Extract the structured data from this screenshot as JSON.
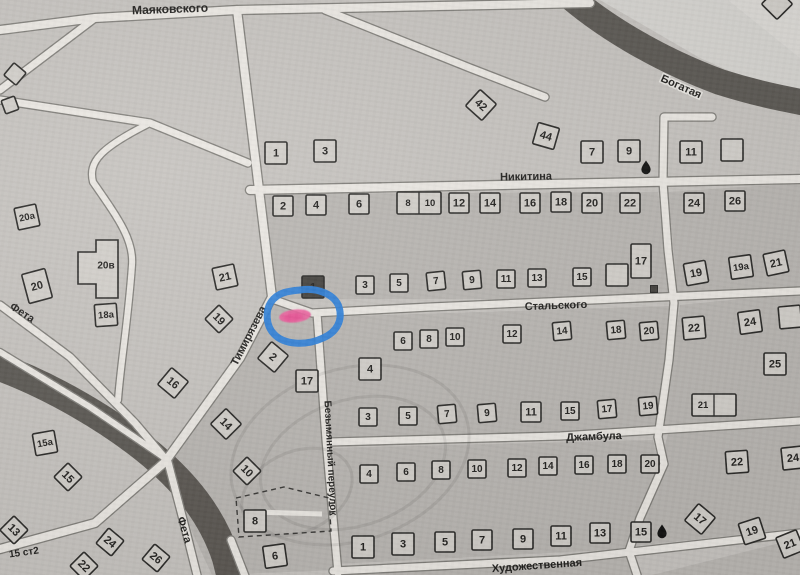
{
  "map_title": "Scanned cadastral street map with highlighted plot",
  "colors": {
    "paper": "#c6c3bf",
    "block": "#b9b6b2",
    "road": "#ebe8e3",
    "road_edge": "#82807b",
    "river": "#55524d",
    "building_fill": "#d2cfca",
    "building_dark": "#45433f",
    "ink": "#2b2a28",
    "annotation_blue": "#2c7fd9",
    "annotation_pink": "#ee5f9e"
  },
  "shading": [
    {
      "pts": "600,0 800,0 800,102 700,58",
      "fill": "#d6d4d0",
      "op": 1
    },
    {
      "pts": "728,0 800,0 800,58",
      "fill": "#dedcd8",
      "op": 0.75
    }
  ],
  "blocks": [
    "256,194 658,192 670,299 274,299",
    "668,192 800,183 800,288 678,297",
    "322,317 672,306 666,433 331,437",
    "272,302 316,316 337,570 212,575 192,532 170,463 240,358",
    "680,305 800,293 800,417 663,429",
    "333,448 653,440 660,467 636,519 627,549 337,564",
    "669,431 800,424 800,528 635,546",
    "340,575 631,557 641,575",
    "652,575 800,538 800,575"
  ],
  "rivers": [
    {
      "d": "M560,-12 C600,25 660,60 720,82 C755,93 780,98 806,103",
      "w": 26
    },
    {
      "d": "M-6,365 C50,385 110,420 152,455 C185,483 212,515 226,558 L231,578",
      "w": 28
    }
  ],
  "roads": [
    {
      "d": "M0,30 L95,18 L237,10 L590,3",
      "w": 8
    },
    {
      "d": "M325,10 L470,68 L545,97",
      "w": 7
    },
    {
      "d": "M95,18 L0,90",
      "w": 7
    },
    {
      "d": "M0,100 L150,123 L248,163",
      "w": 7
    },
    {
      "d": "M150,123 C100,148 88,162 93,182 C118,218 134,240 132,265 C128,322 121,360 118,400",
      "w": 6
    },
    {
      "d": "M237,10 L256,165 L272,297 L240,358 L165,462 L95,523 L0,549",
      "w": 8
    },
    {
      "d": "M0,305 L70,357 L135,423 L168,462 L186,531 L197,575",
      "w": 7
    },
    {
      "d": "M0,352 L90,407 L162,456",
      "w": 6
    },
    {
      "d": "M231,540 L245,576",
      "w": 7
    },
    {
      "d": "M250,190 L800,179",
      "w": 8
    },
    {
      "d": "M272,299 L312,313 L430,307 L800,291",
      "w": 7
    },
    {
      "d": "M330,442 L560,436 L800,421",
      "w": 7
    },
    {
      "d": "M333,571 L560,560 L800,533",
      "w": 7
    },
    {
      "d": "M317,313 L326,440 L338,573",
      "w": 7
    },
    {
      "d": "M712,117 L664,117 L663,182 L668,250 L674,303 L669,360 L658,437 L664,464 L640,518 L629,551 L637,575",
      "w": 7
    }
  ],
  "stamp": [
    {
      "cx": 350,
      "cy": 455,
      "rx": 122,
      "ry": 86,
      "rot": -18
    },
    {
      "cx": 353,
      "cy": 463,
      "rx": 95,
      "ry": 63,
      "rot": -18
    },
    {
      "cx": 297,
      "cy": 492,
      "rx": 58,
      "ry": 40,
      "rot": -25
    }
  ],
  "dashed_parcel": {
    "pts": "236,498 284,487 329,498 331,531 239,537",
    "strip": {
      "x1": 252,
      "y1": 512,
      "x2": 322,
      "y2": 514
    }
  },
  "cross_building": {
    "points": "78,252 96,252 96,240 118,240 118,298 96,298 96,284 78,284",
    "label": "20в",
    "lx": 106,
    "ly": 266
  },
  "buildings": [
    {
      "n": "1",
      "x": 276,
      "y": 153
    },
    {
      "n": "3",
      "x": 325,
      "y": 151
    },
    {
      "n": "42",
      "x": 481,
      "y": 105,
      "r": 42
    },
    {
      "n": "44",
      "x": 546,
      "y": 136,
      "r": 16
    },
    {
      "n": "7",
      "x": 592,
      "y": 152
    },
    {
      "n": "9",
      "x": 629,
      "y": 151
    },
    {
      "n": "11",
      "x": 691,
      "y": 152
    },
    {
      "n": "",
      "x": 732,
      "y": 150
    },
    {
      "n": "",
      "x": 777,
      "y": 4,
      "r": 45
    },
    {
      "n": "2",
      "x": 283,
      "y": 206,
      "w": 20
    },
    {
      "n": "4",
      "x": 316,
      "y": 205,
      "w": 20
    },
    {
      "n": "6",
      "x": 359,
      "y": 204,
      "w": 20
    },
    {
      "n": "8|10",
      "x": 419,
      "y": 203
    },
    {
      "n": "12",
      "x": 459,
      "y": 203,
      "w": 20
    },
    {
      "n": "14",
      "x": 490,
      "y": 203,
      "w": 20
    },
    {
      "n": "16",
      "x": 530,
      "y": 203,
      "w": 20
    },
    {
      "n": "18",
      "x": 561,
      "y": 202,
      "w": 20
    },
    {
      "n": "20",
      "x": 592,
      "y": 203,
      "w": 20
    },
    {
      "n": "22",
      "x": 630,
      "y": 203,
      "w": 20
    },
    {
      "n": "24",
      "x": 694,
      "y": 203,
      "w": 20
    },
    {
      "n": "26",
      "x": 735,
      "y": 201,
      "w": 20
    },
    {
      "n": "1",
      "x": 313,
      "y": 287,
      "t": "d"
    },
    {
      "n": "3",
      "x": 365,
      "y": 285,
      "w": 18
    },
    {
      "n": "5",
      "x": 399,
      "y": 283,
      "w": 18
    },
    {
      "n": "7",
      "x": 436,
      "y": 281,
      "w": 18,
      "r": -6
    },
    {
      "n": "9",
      "x": 472,
      "y": 280,
      "w": 18,
      "r": -5
    },
    {
      "n": "11",
      "x": 506,
      "y": 279,
      "w": 18
    },
    {
      "n": "13",
      "x": 537,
      "y": 278,
      "w": 18
    },
    {
      "n": "15",
      "x": 582,
      "y": 277,
      "w": 18
    },
    {
      "n": "",
      "x": 617,
      "y": 275
    },
    {
      "n": "17",
      "x": 641,
      "y": 261,
      "w": 20,
      "h": 34
    },
    {
      "n": "19",
      "x": 696,
      "y": 273,
      "r": -10
    },
    {
      "n": "19а",
      "x": 741,
      "y": 267,
      "r": -8
    },
    {
      "n": "21",
      "x": 776,
      "y": 263,
      "r": -12
    },
    {
      "n": "2",
      "x": 273,
      "y": 357,
      "r": 40
    },
    {
      "n": "17",
      "x": 307,
      "y": 381
    },
    {
      "n": "10",
      "x": 247,
      "y": 471,
      "r": 45,
      "w": 20
    },
    {
      "n": "8",
      "x": 255,
      "y": 521
    },
    {
      "n": "6",
      "x": 275,
      "y": 556,
      "r": -8
    },
    {
      "n": "6",
      "x": 403,
      "y": 341,
      "w": 18
    },
    {
      "n": "8",
      "x": 429,
      "y": 339,
      "w": 18
    },
    {
      "n": "10",
      "x": 455,
      "y": 337,
      "w": 18
    },
    {
      "n": "12",
      "x": 512,
      "y": 334,
      "w": 18
    },
    {
      "n": "14",
      "x": 562,
      "y": 331,
      "w": 18,
      "r": -5
    },
    {
      "n": "18",
      "x": 616,
      "y": 330,
      "w": 18,
      "r": -5
    },
    {
      "n": "20",
      "x": 649,
      "y": 331,
      "w": 18,
      "r": -5
    },
    {
      "n": "4",
      "x": 370,
      "y": 369
    },
    {
      "n": "3",
      "x": 368,
      "y": 417,
      "w": 18
    },
    {
      "n": "5",
      "x": 408,
      "y": 416,
      "w": 18
    },
    {
      "n": "7",
      "x": 447,
      "y": 414,
      "w": 18,
      "r": -5
    },
    {
      "n": "9",
      "x": 487,
      "y": 413,
      "w": 18,
      "r": -5
    },
    {
      "n": "11",
      "x": 531,
      "y": 412,
      "w": 20
    },
    {
      "n": "15",
      "x": 570,
      "y": 411,
      "w": 18
    },
    {
      "n": "17",
      "x": 607,
      "y": 409,
      "w": 18,
      "r": -5
    },
    {
      "n": "19",
      "x": 648,
      "y": 406,
      "w": 18,
      "r": -5
    },
    {
      "n": "22",
      "x": 694,
      "y": 328,
      "r": -5
    },
    {
      "n": "24",
      "x": 750,
      "y": 322,
      "r": -8
    },
    {
      "n": "",
      "x": 790,
      "y": 317,
      "r": -5
    },
    {
      "n": "25",
      "x": 775,
      "y": 364
    },
    {
      "n": "21|",
      "x": 714,
      "y": 405
    },
    {
      "n": "4",
      "x": 369,
      "y": 474,
      "w": 18
    },
    {
      "n": "6",
      "x": 406,
      "y": 472,
      "w": 18
    },
    {
      "n": "8",
      "x": 441,
      "y": 470,
      "w": 18
    },
    {
      "n": "10",
      "x": 477,
      "y": 469,
      "w": 18
    },
    {
      "n": "12",
      "x": 517,
      "y": 468,
      "w": 18
    },
    {
      "n": "14",
      "x": 548,
      "y": 466,
      "w": 18
    },
    {
      "n": "16",
      "x": 584,
      "y": 465,
      "w": 18
    },
    {
      "n": "18",
      "x": 617,
      "y": 464,
      "w": 18
    },
    {
      "n": "20",
      "x": 650,
      "y": 464,
      "w": 18
    },
    {
      "n": "1",
      "x": 363,
      "y": 547
    },
    {
      "n": "3",
      "x": 403,
      "y": 544
    },
    {
      "n": "5",
      "x": 445,
      "y": 542,
      "w": 20
    },
    {
      "n": "7",
      "x": 482,
      "y": 540,
      "w": 20
    },
    {
      "n": "9",
      "x": 523,
      "y": 539,
      "w": 20
    },
    {
      "n": "11",
      "x": 561,
      "y": 536,
      "w": 20
    },
    {
      "n": "13",
      "x": 600,
      "y": 533,
      "w": 20
    },
    {
      "n": "15",
      "x": 641,
      "y": 532,
      "w": 20
    },
    {
      "n": "22",
      "x": 737,
      "y": 462,
      "r": -4
    },
    {
      "n": "24",
      "x": 793,
      "y": 458,
      "r": -6
    },
    {
      "n": "17",
      "x": 700,
      "y": 519,
      "r": 40
    },
    {
      "n": "19",
      "x": 752,
      "y": 531,
      "r": -18
    },
    {
      "n": "21",
      "x": 790,
      "y": 544,
      "r": -22
    },
    {
      "n": "20а",
      "x": 27,
      "y": 217,
      "r": -12
    },
    {
      "n": "20",
      "x": 37,
      "y": 286,
      "r": -15,
      "w": 24,
      "h": 30
    },
    {
      "n": "18а",
      "x": 106,
      "y": 315,
      "r": -4
    },
    {
      "n": "21",
      "x": 225,
      "y": 277,
      "r": -12
    },
    {
      "n": "19",
      "x": 219,
      "y": 319,
      "r": 45,
      "w": 20
    },
    {
      "n": "16",
      "x": 173,
      "y": 383,
      "r": 40
    },
    {
      "n": "14",
      "x": 226,
      "y": 424,
      "r": 45
    },
    {
      "n": "15а",
      "x": 45,
      "y": 443,
      "r": -10
    },
    {
      "n": "15",
      "x": 68,
      "y": 477,
      "r": 45,
      "w": 20
    },
    {
      "n": "13",
      "x": 14,
      "y": 530,
      "r": 45,
      "w": 20
    },
    {
      "n": "24",
      "x": 110,
      "y": 542,
      "r": 40,
      "w": 20
    },
    {
      "n": "22",
      "x": 84,
      "y": 566,
      "r": 45,
      "w": 20
    },
    {
      "n": "26",
      "x": 156,
      "y": 558,
      "r": 40,
      "w": 20
    },
    {
      "n": "",
      "x": 15,
      "y": 74,
      "r": 40,
      "w": 16
    },
    {
      "n": "",
      "x": 10,
      "y": 105,
      "r": -20,
      "w": 14
    }
  ],
  "street_labels": [
    {
      "name": "Маяковского",
      "x": 170,
      "y": 9,
      "r": -2,
      "fs": 12
    },
    {
      "name": "Богатая",
      "x": 681,
      "y": 87,
      "r": 24,
      "fs": 11,
      "halo": true
    },
    {
      "name": "Никитина",
      "x": 526,
      "y": 177,
      "r": -1,
      "fs": 11
    },
    {
      "name": "Стальского",
      "x": 556,
      "y": 306,
      "r": -2,
      "fs": 11
    },
    {
      "name": "Джамбула",
      "x": 594,
      "y": 437,
      "r": -2,
      "fs": 11
    },
    {
      "name": "Художественная",
      "x": 537,
      "y": 566,
      "r": -4,
      "fs": 11
    },
    {
      "name": "Тимирязева",
      "x": 249,
      "y": 336,
      "r": -63,
      "fs": 11
    },
    {
      "name": "Безымянный переулок",
      "x": 330,
      "y": 458,
      "r": 87,
      "fs": 10
    },
    {
      "name": "Фета",
      "x": 22,
      "y": 313,
      "r": 33,
      "fs": 11
    },
    {
      "name": "Фета",
      "x": 184,
      "y": 530,
      "r": 73,
      "fs": 11
    },
    {
      "name": "15 ст2",
      "x": 24,
      "y": 553,
      "r": -8,
      "fs": 10
    }
  ],
  "icons": {
    "droplets": [
      {
        "x": 646,
        "y": 167
      },
      {
        "x": 662,
        "y": 531
      }
    ],
    "dark_dot": {
      "x": 654,
      "y": 289,
      "s": 7
    }
  },
  "annotation": {
    "pink_marker": {
      "cx": 295,
      "cy": 316,
      "rx": 16,
      "ry": 6.5,
      "rot": -6
    },
    "blue_circle_path": "M300,290 C318,287 335,295 339,307 C343,320 337,332 323,338 C306,346 284,345 274,334 C266,326 265,311 271,302 C278,292 289,291 300,290 Z"
  }
}
